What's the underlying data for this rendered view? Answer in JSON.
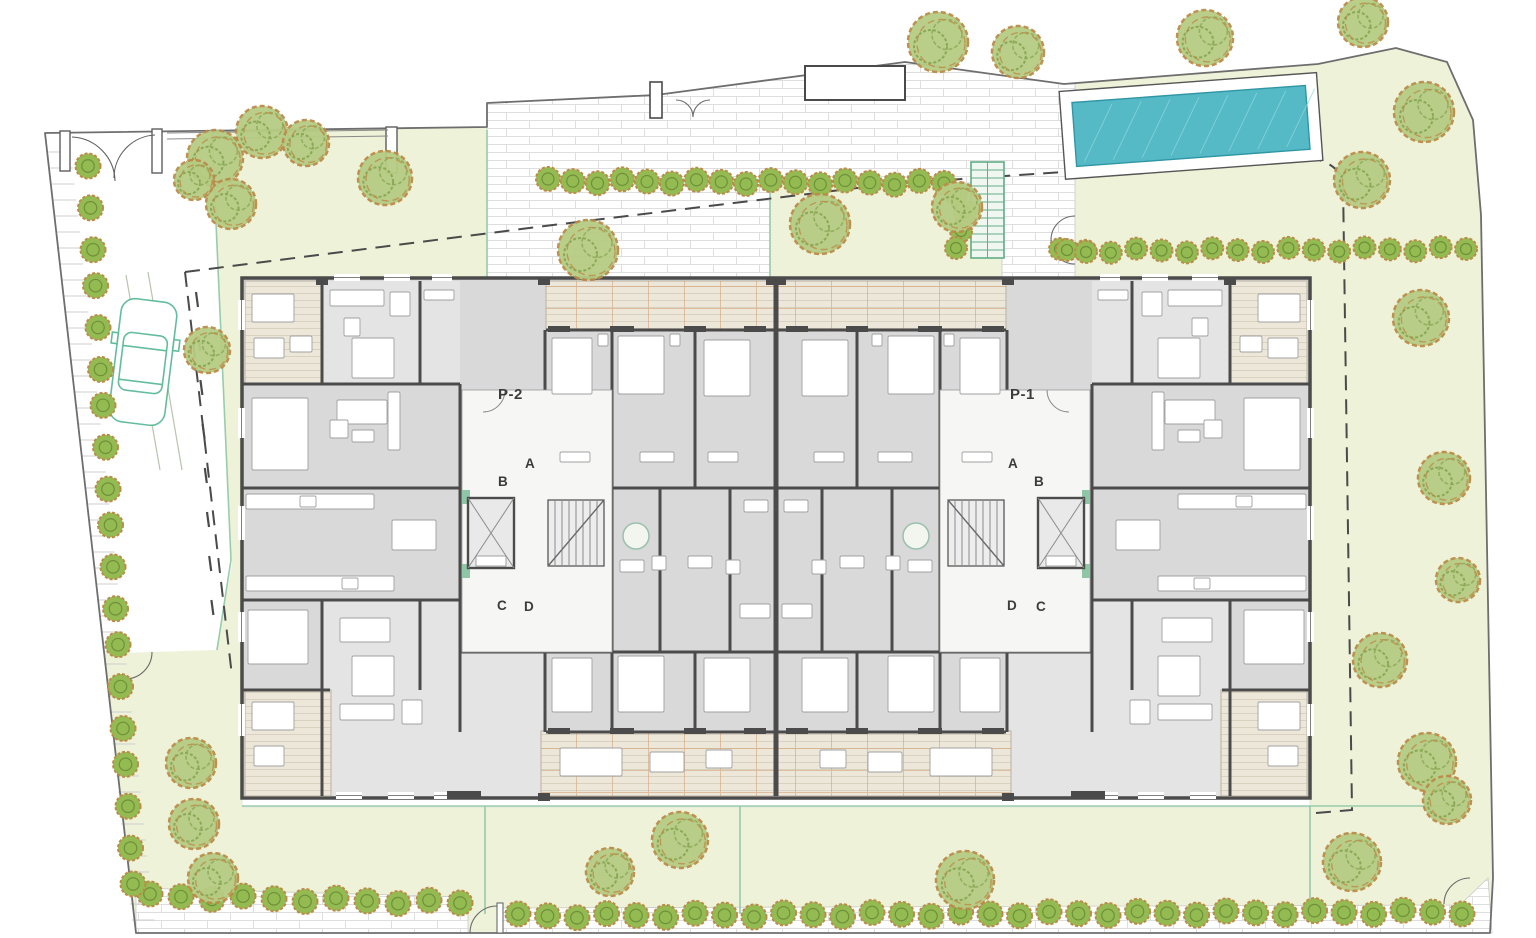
{
  "labels": {
    "core_left": {
      "name": "P-2",
      "a": "A",
      "b": "B",
      "c": "C",
      "d": "D"
    },
    "core_right": {
      "name": "P-1",
      "a": "A",
      "b": "B",
      "c": "C",
      "d": "D"
    }
  },
  "colors": {
    "lawn": "#edf2d8",
    "lawn_line": "#8fc7a6",
    "pave_line": "#dcdcdc",
    "boundary": "#6e6e6e",
    "dash": "#4a4a4a",
    "wall": "#4b4b4b",
    "floor": "#d9d9d9",
    "floor_light": "#e4e4e4",
    "corridor": "#f6f6f5",
    "furniture_fill": "#ffffff",
    "furniture_line": "#a0a0a0",
    "deck_base": "#ede7d9",
    "deck_line": "#d9d1bf",
    "deck_orange": "#cf9e70",
    "water": "#55bac6",
    "water_edge": "#2f96a5",
    "water_hatch": "#8ed8de",
    "tree_fill": "#b6cc83",
    "tree_hatch": "#8aa855",
    "tree_ring": "#bb8b49",
    "bush_fill": "#94bb52",
    "bush_inner": "#6f8f3a",
    "green_accent": "#5fae85",
    "car_green": "#63bd9c",
    "label_ink": "#3c3c3c"
  },
  "site": {
    "outline": "45,133 487,127 487,103 656,95 905,62 1064,84 1318,64 1396,48 1447,62 1473,120 1481,215 1493,878 1490,933 136,933",
    "driveway": "45,133 212,131 232,565 216,650 125,653 100,650",
    "paved_top": "487,103 656,95 905,62 1064,84 1075,84 1075,290 1002,290 1002,183 770,183 770,277 487,277",
    "sidewalk_left": "136,888 468,897 468,933 136,933",
    "sidewalk_right": "503,908 1460,905 1488,878 1492,933 503,933",
    "bottom_path": [
      242,
      797,
      1068,
      10
    ],
    "setback_dashed": "M185,272 L545,226 L890,184 L1063,172 L1290,157 Q1336,156 1343,182 L1352,810 L1316,813",
    "setback_dashed2": "M185,272 L232,676",
    "accent_lines": [
      [
        487,
        130,
        487,
        277
      ],
      [
        770,
        182,
        770,
        277
      ],
      [
        242,
        806,
        1470,
        806
      ],
      [
        485,
        806,
        485,
        914
      ],
      [
        740,
        806,
        740,
        914
      ],
      [
        1310,
        806,
        1310,
        910
      ],
      [
        212,
        133,
        231,
        560
      ],
      [
        231,
        560,
        217,
        650
      ]
    ],
    "fence_top": [
      [
        167,
        133,
        388,
        130
      ],
      [
        167,
        139,
        388,
        136
      ]
    ],
    "ramp_lines": [
      [
        126,
        275,
        160,
        470
      ],
      [
        148,
        272,
        182,
        470
      ]
    ]
  },
  "pool": {
    "deck": [
      1062,
      82,
      258,
      88
    ],
    "water": [
      1074,
      94,
      234,
      64
    ],
    "angle": -4.2,
    "cx": 1190,
    "cy": 126,
    "hatch_n": 8
  },
  "building": {
    "x": 242,
    "y": 278,
    "w": 1068,
    "h": 520,
    "mirror_axis": 776,
    "light_rooms": [
      [
        322,
        281,
        138,
        103
      ],
      [
        322,
        600,
        223,
        196
      ]
    ],
    "terraces": [
      {
        "x": 245,
        "y": 281,
        "w": 78,
        "h": 102,
        "kind": "plain"
      },
      {
        "x": 245,
        "y": 690,
        "w": 86,
        "h": 106,
        "kind": "plain"
      },
      {
        "x": 546,
        "y": 281,
        "w": 228,
        "h": 49,
        "kind": "grid"
      },
      {
        "x": 541,
        "y": 731,
        "w": 233,
        "h": 65,
        "kind": "grid"
      }
    ],
    "walls": [
      [
        322,
        281,
        322,
        384
      ],
      [
        420,
        281,
        420,
        384
      ],
      [
        242,
        384,
        460,
        384
      ],
      [
        242,
        488,
        460,
        488
      ],
      [
        242,
        600,
        460,
        600
      ],
      [
        242,
        690,
        330,
        690
      ],
      [
        322,
        600,
        322,
        796
      ],
      [
        420,
        600,
        420,
        690
      ],
      [
        460,
        384,
        460,
        652
      ],
      [
        612,
        330,
        612,
        652
      ],
      [
        695,
        330,
        695,
        488
      ],
      [
        545,
        330,
        545,
        488
      ],
      [
        660,
        488,
        660,
        652
      ],
      [
        730,
        488,
        730,
        652
      ],
      [
        460,
        652,
        774,
        652
      ],
      [
        546,
        330,
        774,
        330
      ],
      [
        545,
        488,
        774,
        488
      ],
      [
        546,
        732,
        774,
        732
      ],
      [
        460,
        652,
        460,
        732
      ],
      [
        545,
        652,
        545,
        732
      ],
      [
        612,
        652,
        612,
        732
      ],
      [
        695,
        652,
        695,
        732
      ]
    ],
    "furniture": [
      [
        330,
        290,
        54,
        16
      ],
      [
        390,
        292,
        20,
        24
      ],
      [
        344,
        318,
        16,
        18
      ],
      [
        352,
        338,
        42,
        40
      ],
      [
        337,
        400,
        50,
        24
      ],
      [
        352,
        430,
        22,
        12
      ],
      [
        252,
        294,
        42,
        28
      ],
      [
        254,
        338,
        30,
        20
      ],
      [
        290,
        336,
        22,
        16
      ],
      [
        424,
        290,
        30,
        10
      ],
      [
        552,
        338,
        40,
        56
      ],
      [
        618,
        336,
        46,
        58
      ],
      [
        704,
        340,
        46,
        56
      ],
      [
        598,
        334,
        10,
        12
      ],
      [
        670,
        334,
        10,
        12
      ],
      [
        560,
        452,
        30,
        10
      ],
      [
        640,
        452,
        34,
        10
      ],
      [
        708,
        452,
        30,
        10
      ],
      [
        252,
        398,
        56,
        72
      ],
      [
        330,
        420,
        18,
        18
      ],
      [
        388,
        392,
        12,
        58
      ],
      [
        246,
        494,
        128,
        15
      ],
      [
        300,
        496,
        16,
        11
      ],
      [
        246,
        576,
        148,
        15
      ],
      [
        342,
        578,
        16,
        11
      ],
      [
        392,
        520,
        44,
        30
      ],
      [
        620,
        560,
        24,
        12
      ],
      [
        652,
        556,
        14,
        14
      ],
      [
        688,
        556,
        24,
        12
      ],
      [
        726,
        560,
        14,
        14
      ],
      [
        744,
        500,
        24,
        12
      ],
      [
        740,
        604,
        30,
        14
      ],
      [
        340,
        704,
        54,
        16
      ],
      [
        402,
        700,
        20,
        24
      ],
      [
        352,
        656,
        42,
        40
      ],
      [
        340,
        618,
        50,
        24
      ],
      [
        552,
        658,
        40,
        54
      ],
      [
        618,
        656,
        46,
        56
      ],
      [
        704,
        658,
        46,
        54
      ],
      [
        252,
        702,
        42,
        28
      ],
      [
        254,
        746,
        30,
        20
      ],
      [
        248,
        610,
        60,
        54
      ],
      [
        560,
        748,
        62,
        28
      ],
      [
        650,
        752,
        34,
        20
      ],
      [
        706,
        750,
        26,
        18
      ]
    ],
    "windows": [
      [
        334,
        274,
        26,
        7
      ],
      [
        384,
        274,
        26,
        7
      ],
      [
        432,
        274,
        20,
        7
      ],
      [
        238,
        300,
        7,
        30
      ],
      [
        238,
        408,
        7,
        30
      ],
      [
        238,
        506,
        7,
        34
      ],
      [
        238,
        612,
        7,
        30
      ],
      [
        238,
        704,
        7,
        32
      ],
      [
        336,
        792,
        26,
        7
      ],
      [
        388,
        792,
        26,
        7
      ],
      [
        434,
        792,
        22,
        7
      ]
    ],
    "piers": [
      [
        548,
        326,
        22,
        6
      ],
      [
        610,
        326,
        24,
        6
      ],
      [
        684,
        326,
        22,
        6
      ],
      [
        744,
        326,
        22,
        6
      ],
      [
        548,
        728,
        22,
        6
      ],
      [
        610,
        728,
        24,
        6
      ],
      [
        684,
        728,
        22,
        6
      ],
      [
        744,
        728,
        22,
        6
      ],
      [
        538,
        277,
        12,
        8
      ],
      [
        766,
        277,
        10,
        8
      ],
      [
        538,
        793,
        12,
        8
      ],
      [
        447,
        791,
        34,
        8
      ],
      [
        316,
        277,
        12,
        8
      ]
    ]
  },
  "core": {
    "corridor": [
      462,
      390,
      150,
      262
    ],
    "elevator": [
      468,
      498,
      46,
      70
    ],
    "elevator_inner": [
      476,
      556,
      30,
      10
    ],
    "stair": [
      548,
      500,
      56,
      66
    ],
    "stair_steps": 8,
    "lightwell": [
      636,
      536,
      13
    ],
    "accents": [
      [
        462,
        490,
        8,
        14
      ],
      [
        462,
        564,
        8,
        14
      ]
    ],
    "hall_arc": "M505,390 A22,22 0 0 1 483,412"
  },
  "exterior_stair": {
    "x": 971,
    "y": 162,
    "w": 33,
    "h": 96,
    "steps": 12
  },
  "car": {
    "x": 115,
    "y": 300,
    "w": 56,
    "h": 124,
    "angle": 7,
    "cx": 143,
    "cy": 362
  },
  "trees": [
    [
      938,
      42,
      30
    ],
    [
      1018,
      52,
      26
    ],
    [
      1205,
      38,
      28
    ],
    [
      1363,
      22,
      25
    ],
    [
      1424,
      112,
      30
    ],
    [
      1362,
      180,
      28
    ],
    [
      215,
      158,
      28
    ],
    [
      262,
      132,
      26
    ],
    [
      306,
      143,
      23
    ],
    [
      231,
      204,
      25
    ],
    [
      194,
      180,
      20
    ],
    [
      385,
      178,
      27
    ],
    [
      207,
      350,
      23
    ],
    [
      588,
      250,
      30
    ],
    [
      820,
      224,
      30
    ],
    [
      957,
      207,
      25
    ],
    [
      1421,
      318,
      28
    ],
    [
      1444,
      478,
      26
    ],
    [
      1458,
      580,
      22
    ],
    [
      1380,
      660,
      27
    ],
    [
      1427,
      762,
      29
    ],
    [
      1352,
      862,
      29
    ],
    [
      1447,
      800,
      24
    ],
    [
      965,
      880,
      29
    ],
    [
      680,
      840,
      28
    ],
    [
      610,
      872,
      24
    ],
    [
      191,
      763,
      25
    ],
    [
      194,
      824,
      25
    ],
    [
      213,
      878,
      25
    ]
  ],
  "bush_rows": [
    {
      "x1": 548,
      "y1": 181,
      "x2": 944,
      "y2": 183,
      "n": 17,
      "r": 12
    },
    {
      "x1": 1060,
      "y1": 251,
      "x2": 1466,
      "y2": 249,
      "n": 17,
      "r": 11
    },
    {
      "x1": 518,
      "y1": 916,
      "x2": 1462,
      "y2": 912,
      "n": 33,
      "r": 12.5
    },
    {
      "x1": 150,
      "y1": 896,
      "x2": 460,
      "y2": 903,
      "n": 11,
      "r": 12.5
    },
    {
      "x1": 88,
      "y1": 168,
      "x2": 133,
      "y2": 886,
      "n": 19,
      "r": 12.5
    }
  ],
  "bushes_extra": [
    [
      956,
      194,
      11
    ],
    [
      965,
      212,
      11
    ],
    [
      961,
      231,
      11
    ],
    [
      956,
      248,
      11
    ],
    [
      1067,
      250,
      11
    ],
    [
      1086,
      252,
      11
    ]
  ],
  "ticks": {
    "y1": 152,
    "y2": 924,
    "step": 16,
    "x0": 45,
    "yref": 133,
    "slope": 0.1085,
    "len": 24
  },
  "drive_dashes": {
    "y1": 292,
    "y2": 640,
    "step": 44
  }
}
